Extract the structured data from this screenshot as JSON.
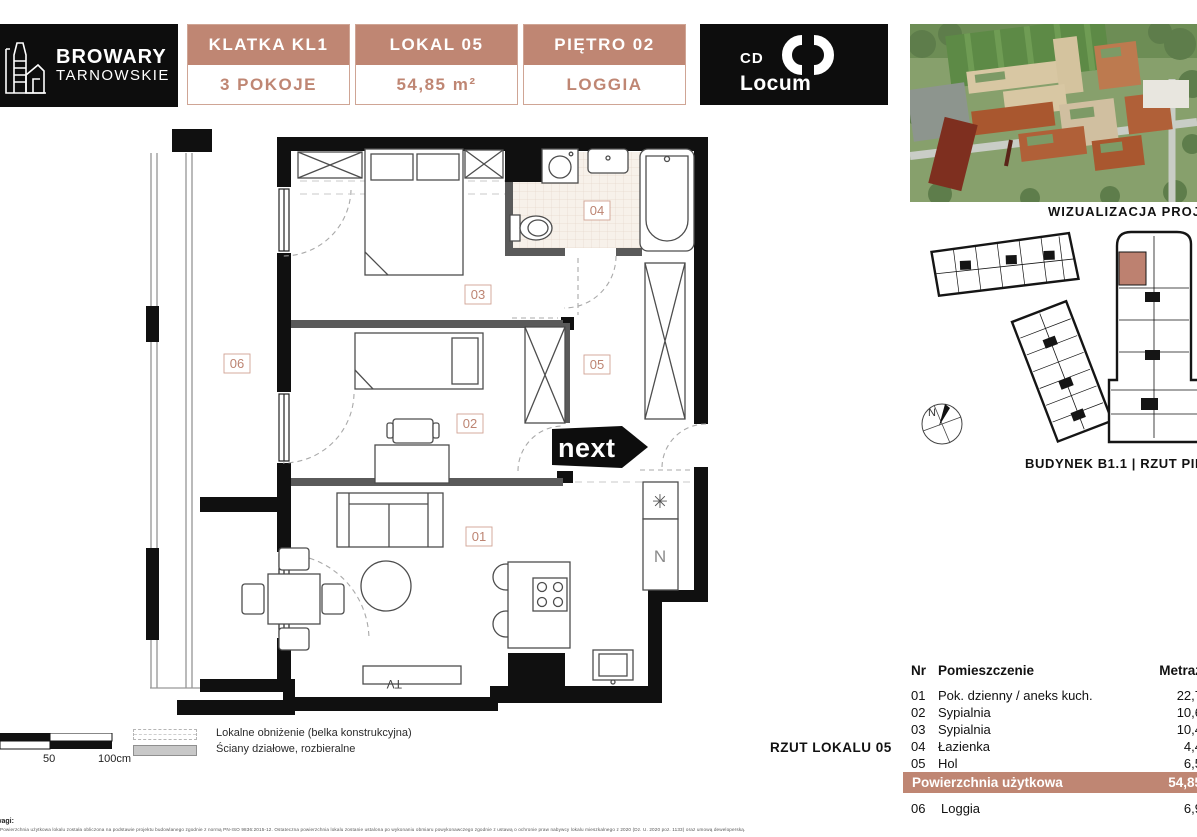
{
  "header": {
    "logo": {
      "line1": "BROWARY",
      "line2": "TARNOWSKIE"
    },
    "boxes": [
      {
        "top": "KLATKA KL1",
        "bottom": "3 POKOJE"
      },
      {
        "top": "LOKAL 05",
        "bottom": "54,85 m²"
      },
      {
        "top": "PIĘTRO 02",
        "bottom": "LOGGIA"
      }
    ],
    "brand": {
      "cd": "CD",
      "locum": "Locum"
    }
  },
  "right_panel": {
    "visual_caption": "WIZUALIZACJA PROJEKTU",
    "building_caption": "BUDYNEK B1.1 | RZUT PIĘTRA 02",
    "compass_label": "N"
  },
  "floor_plan": {
    "rooms": {
      "r01": "01",
      "r02": "02",
      "r03": "03",
      "r04": "04",
      "r05": "05",
      "r06": "06"
    },
    "next_logo": "next",
    "tv_label": "TV",
    "fridge_symbol": "✳",
    "appliance_symbol": "N",
    "caption": "RZUT LOKALU 05"
  },
  "legend": {
    "scale_50": "50",
    "scale_100": "100cm",
    "items": [
      "Lokalne obniżenie (belka konstrukcyjna)",
      "Ściany działowe, rozbieralne"
    ]
  },
  "table": {
    "headers": {
      "nr": "Nr",
      "name": "Pomieszczenie",
      "area": "Metraż"
    },
    "rows": [
      {
        "nr": "01",
        "name": "Pok. dzienny / aneks kuch.",
        "area": "22,7"
      },
      {
        "nr": "02",
        "name": "Sypialnia",
        "area": "10,6"
      },
      {
        "nr": "03",
        "name": "Sypialnia",
        "area": "10,4"
      },
      {
        "nr": "04",
        "name": "Łazienka",
        "area": "4,4"
      },
      {
        "nr": "05",
        "name": "Hol",
        "area": "6,5"
      }
    ],
    "total": {
      "label": "Powierzchnia użytkowa",
      "value": "54,85"
    },
    "extra_row": {
      "nr": "06",
      "name": "Loggia",
      "area": "6,9"
    }
  },
  "footer": {
    "notes_label": "Uwagi:",
    "notes_text": "Powierzchnia użytkowa lokalu została obliczona na podstawie projektu budowlanego zgodnie z normą PN-ISO 9836:2015-12. Ostateczna powierzchnia lokalu zostanie ustalona po wykonaniu obmiaru powykonawczego zgodnie z ustawą o ochronie praw nabywcy lokalu mieszkalnego z 2020 (Dz. U. 2020 poz. 1133) oraz umową deweloperską."
  },
  "colors": {
    "accent": "#bf8673",
    "accent_border": "#cfa595",
    "black": "#111111"
  }
}
